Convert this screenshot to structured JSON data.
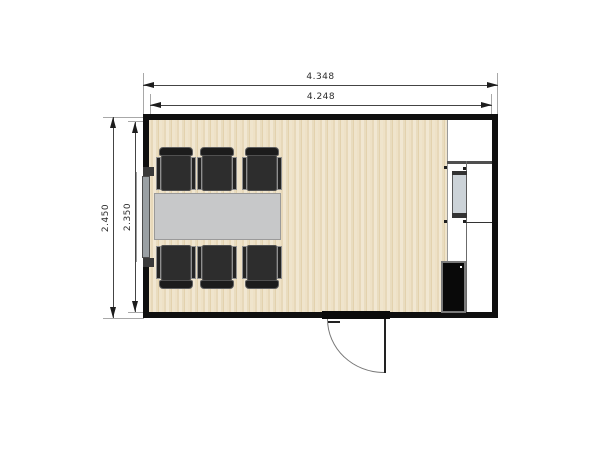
{
  "title": "meeting-room-floor-plan",
  "dimensions": {
    "top_outer_label": "4.348",
    "top_inner_label": "4.248",
    "left_outer_label": "2.450",
    "left_inner_label": "2.350"
  },
  "objects": {
    "chairs_count": 6,
    "table": "conference-table",
    "door": "outward-swing-door",
    "window": "left-wall-window",
    "radiator": "wall-radiator",
    "cabinet": "electrical-cabinet",
    "utility_zone": "right-side-shelf-column"
  },
  "colors": {
    "wall": "#0f0f0f",
    "floor_light": "#f1e7d2",
    "floor_dark": "#e3d2ae",
    "table": "#c7c8c9",
    "chair": "#2d2d2d",
    "utility_background": "#ffffff",
    "radiator_fill": "#ccd3d8",
    "cabinet_fill": "#090909",
    "dimension_text": "#2b2b2b"
  }
}
